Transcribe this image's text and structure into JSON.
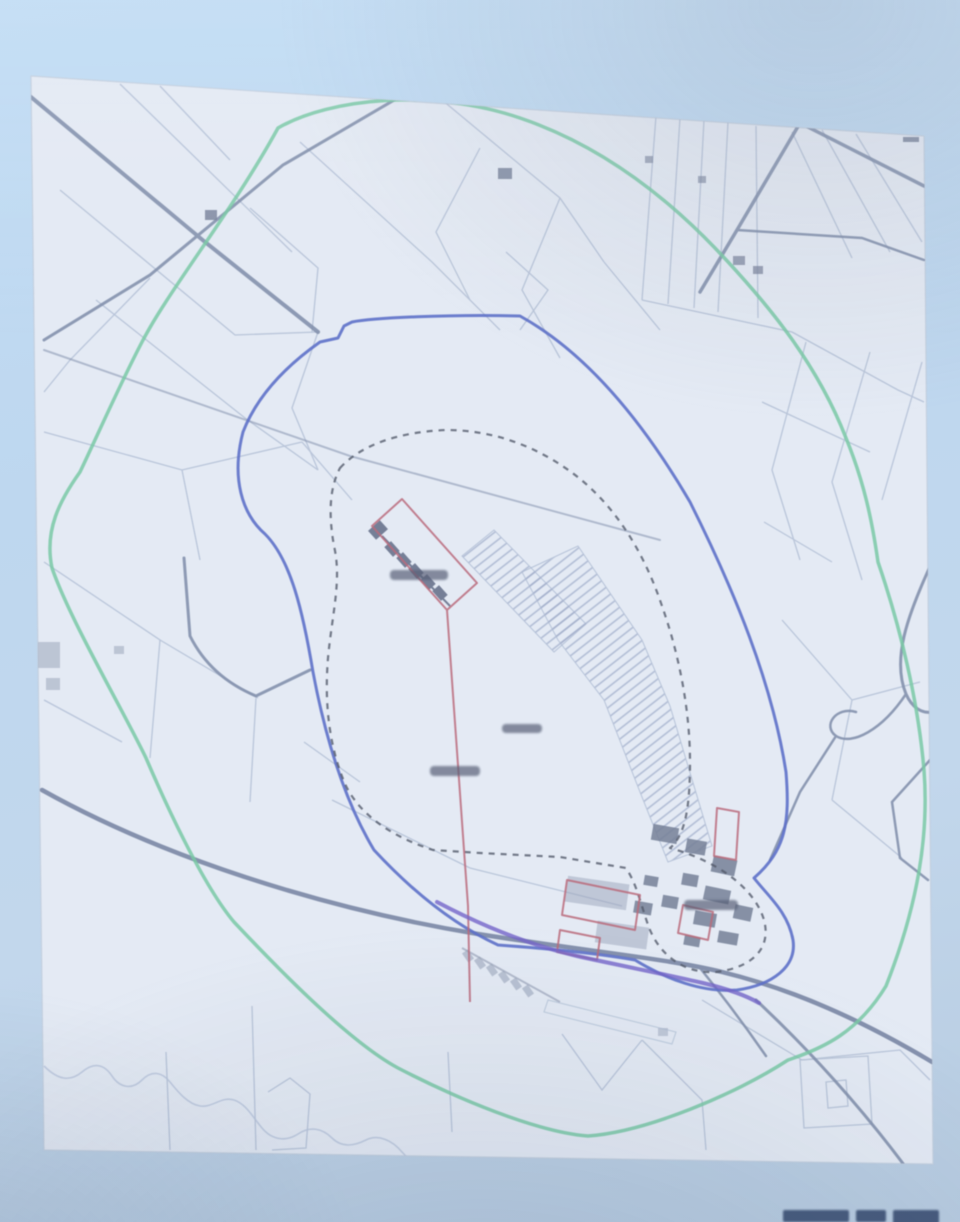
{
  "photo": {
    "kind": "photograph of a projected cadastral planning map",
    "legible_text": "none (all map labels and bottom-right caption are blurred/cut off)"
  },
  "colors": {
    "background": "#bfd8f0",
    "sheet": "#e4ebf5",
    "sheet_edge": "#c3cfdf",
    "wash": "#e2ebf7",
    "parcel_line": "#9fafca",
    "road": "#6d7d9c",
    "road_dark": "#617192",
    "green_boundary": "#5fc493",
    "blue_boundary": "#3f57c2",
    "dashed_boundary": "#343c4e",
    "red_outline": "#b54f60",
    "purple_line": "#5c49c4",
    "hatch_line": "#93a2c2",
    "building_fill": "#8b96ad",
    "building_dark": "#5d6883",
    "stream": "#aebcd4",
    "label_smudge": "#3a425c",
    "caption_smudge": "#2c4066"
  },
  "map": {
    "boundary_layers": [
      "green-perimeter-ring",
      "blue-zone-boundary",
      "dashed-inner-boundary",
      "red-site-outline",
      "purple-route-line"
    ]
  }
}
